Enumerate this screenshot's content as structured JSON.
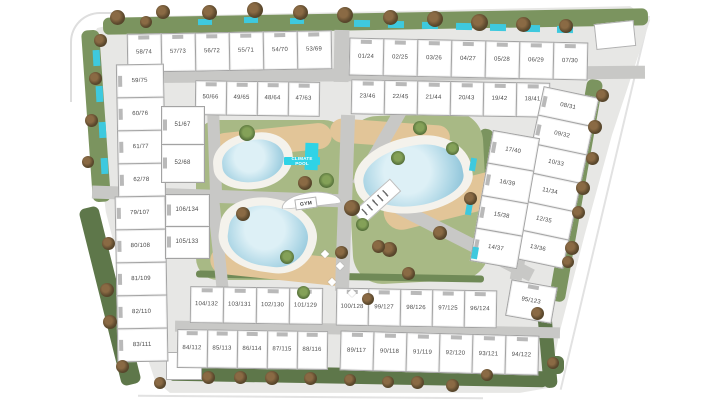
{
  "site_plan": {
    "unit_groups": {
      "top_row_left": [
        "58/74",
        "57/73",
        "56/72",
        "55/71",
        "54/70",
        "53/69"
      ],
      "top_row_right": [
        "01/24",
        "02/25",
        "03/26",
        "04/27",
        "05/28",
        "06/29",
        "07/30"
      ],
      "second_row_left": [
        "50/66",
        "49/65",
        "48/64",
        "47/63"
      ],
      "second_row_right": [
        "23/46",
        "22/45",
        "21/44",
        "20/43",
        "19/42",
        "18/41"
      ],
      "left_column_upper": [
        "59/75",
        "60/76",
        "61/77",
        "62/78"
      ],
      "left_column_inner": [
        "51/67",
        "52/68"
      ],
      "right_column_outer": [
        "08/31",
        "09/32",
        "10/33",
        "11/34",
        "12/35",
        "13/36"
      ],
      "right_column_inner": [
        "17/40",
        "16/39",
        "15/38",
        "14/37"
      ],
      "left_column_lower": [
        "79/107",
        "80/108",
        "81/109",
        "82/110",
        "83/111"
      ],
      "left_column_lower_inner": [
        "106/134",
        "105/133"
      ],
      "bottom_inner_row_left": [
        "104/132",
        "103/131",
        "102/130",
        "101/129"
      ],
      "bottom_inner_row_right": [
        "100/128",
        "99/127",
        "98/126",
        "97/125",
        "96/124"
      ],
      "bottom_corner_unit": [
        "95/123"
      ],
      "bottom_outer_row_left": [
        "84/112",
        "85/113",
        "86/114",
        "87/115",
        "88/116"
      ],
      "bottom_outer_row_right": [
        "89/117",
        "90/118",
        "91/119",
        "92/120",
        "93/121",
        "94/122"
      ]
    },
    "amenities": {
      "climate_pool_label": "CLIMATE POOL",
      "gym_label": "GYM"
    },
    "colors": {
      "pool_water": "#a9d4e4",
      "climate_pool": "#2fd3e6",
      "lawn": "#a8b985",
      "perimeter_green": "#7b945f",
      "road": "#c8c8c6",
      "building": "#ffffff",
      "site_base": "#e7e7e5"
    }
  }
}
